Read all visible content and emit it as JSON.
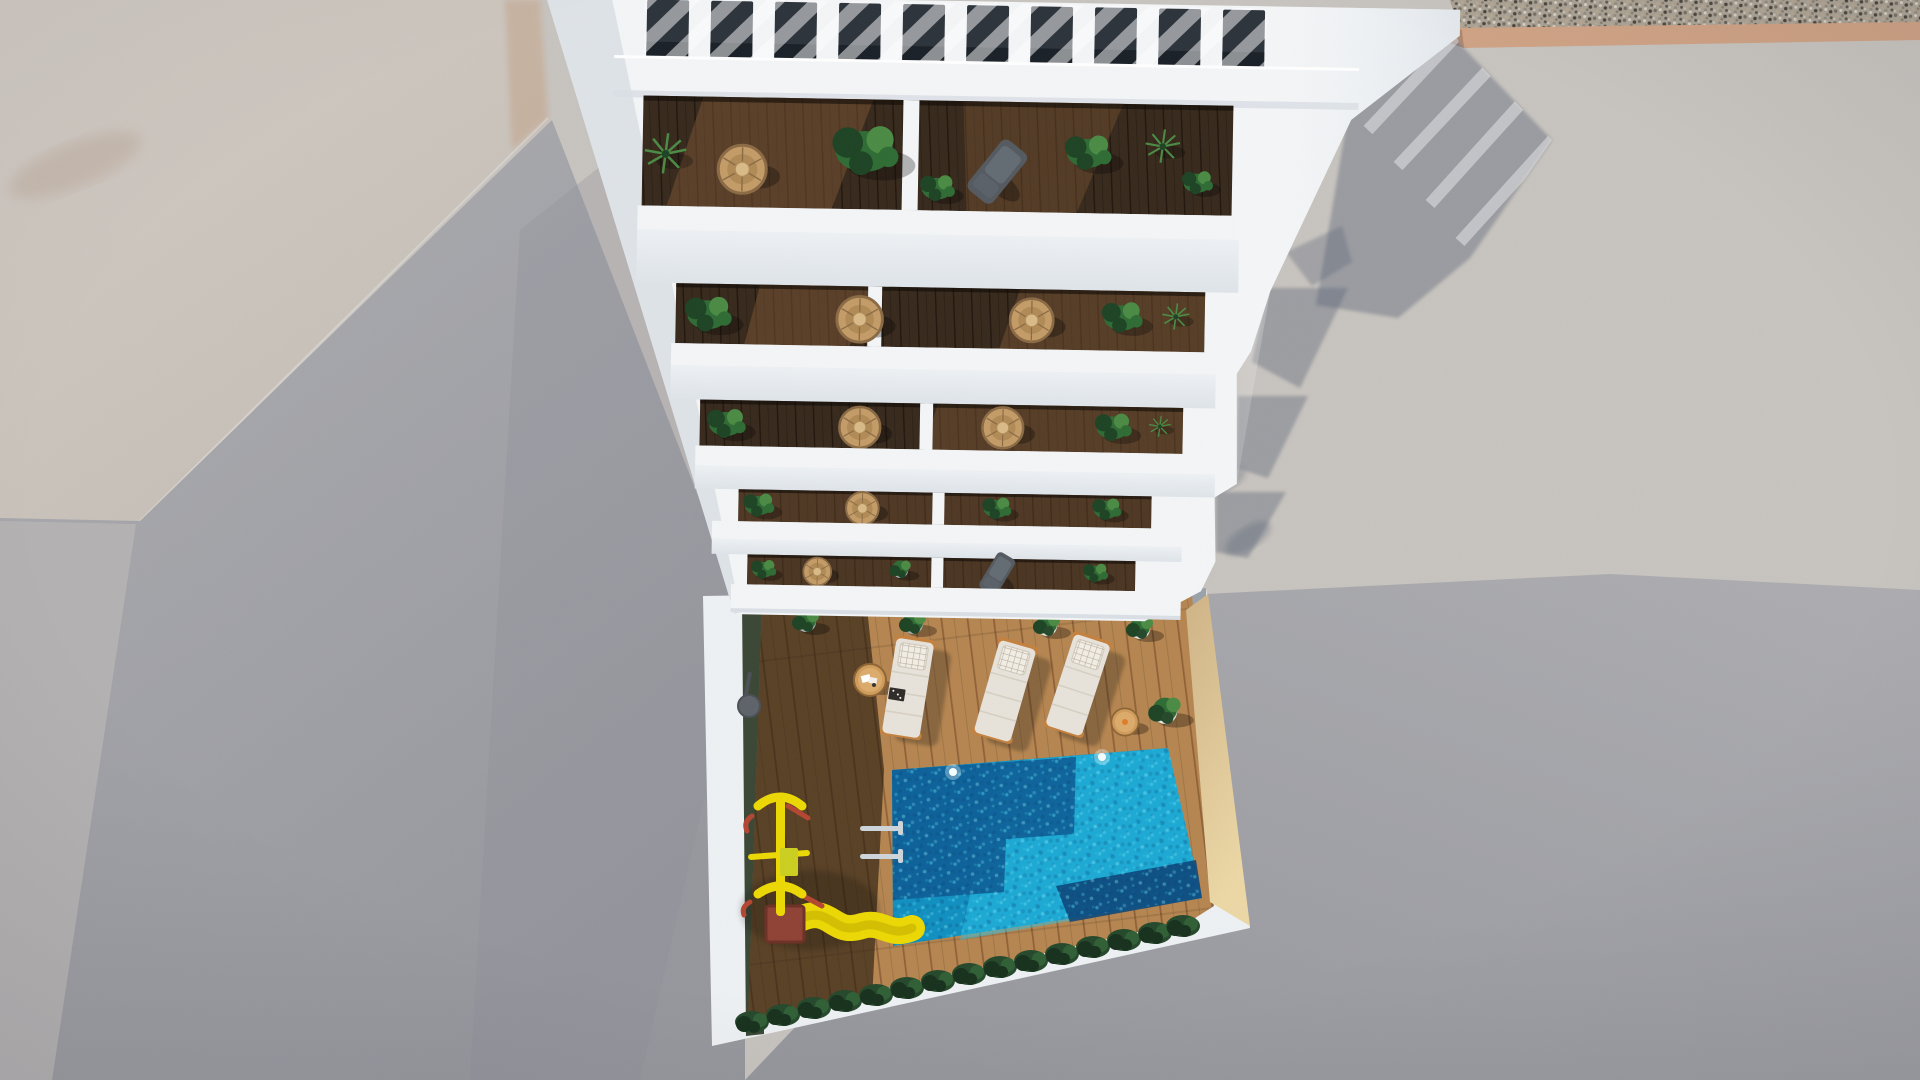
{
  "scene": {
    "description": "Top-down aerial 3D architectural render of a white apartment building with a rooftop pergola, five stepped balcony levels with plants and rattan chairs, and a ground-floor pool terrace with wooden deck, three sun loungers, a children's slide playground and a turquoise swimming pool, surrounded by sunlit concrete, a gravel strip and long cast shadows",
    "view": "bird's-eye / top-down render, no visible text",
    "building": {
      "color_name": "white",
      "pergola_slat_gaps": 10,
      "balcony_levels": 5,
      "units_per_level": 2,
      "balcony_items": [
        "potted green plants",
        "palm plants",
        "round rattan chairs",
        "gray sling sun chair",
        "dark wood decking"
      ]
    },
    "pool_terrace": {
      "deck_material": "wood planks, half in building shadow",
      "sun_loungers": 3,
      "side_tables": 2,
      "potted_plants": 5,
      "pool": {
        "shape": "rectangular",
        "water": "turquoise",
        "underwater_lights": 2,
        "ladder": true
      },
      "playground": {
        "slide": "yellow",
        "frame": "yellow and red",
        "platform": "dark red"
      },
      "perimeter": {
        "left": "hedge strip",
        "bottom": "dense green bushes",
        "wall": "white cap with sand-colored inner face"
      }
    },
    "surroundings": {
      "top_left": "neighboring light concrete rooftop",
      "top_right": "gravel strip with tan curb",
      "right": "sunlit concrete ground with stepped building shadows",
      "bottom_left": "street surface in shadow"
    },
    "palette": {
      "concrete_sunlit": "#c7c3be",
      "roof_warm_a": "#d3ccc5",
      "roof_warm_b": "#c4bdb5",
      "ground_shadow_a": "#adadb1",
      "ground_shadow_b": "#96979d",
      "ground_shadow_light": "#b3b1b1",
      "cast_shadow": "#5c6577",
      "gravel_base": "#aba395",
      "gravel_tan": "#cfa284",
      "building_white": "#f3f5f7",
      "building_white_dark": "#d9dfe5",
      "pergola_void": "#2b323a",
      "balcony_wood": "#36281b",
      "balcony_wood_sun": "#7c5433",
      "deck_sun": "#b5854f",
      "deck_line": "#8f6036",
      "hedge": "#3a4634",
      "bush_dark": "#16301c",
      "bush_mid": "#24472a",
      "bush_light": "#2f5e34",
      "plant_green": "#2e6b33",
      "plant_dark": "#1c4323",
      "plant_light": "#4a8a43",
      "wicker": "#c39b66",
      "wicker_dark": "#8a6a44",
      "pool_base": "#0f8fc0",
      "pool_bright": "#27c3e8",
      "pool_shadow": "#0b5c95",
      "pool_dark": "#093f74",
      "sand_wall_a": "#cfb386",
      "sand_wall_b": "#ecd7a5",
      "terrace_white": "#eef1f3",
      "lounger_cushion": "#e7e2da",
      "lounger_pillow": "#f2eee5",
      "lounger_frame": "#c4803d",
      "table_wood": "#cf9b59",
      "slide_yellow": "#ecd803",
      "play_red": "#b34530",
      "platform_red": "#8e4134",
      "ladder_chrome": "#cdd5da",
      "chair_gray": "#53595f",
      "pot_gray": "#a8adb0",
      "pot_white": "#e8e6e1"
    }
  }
}
